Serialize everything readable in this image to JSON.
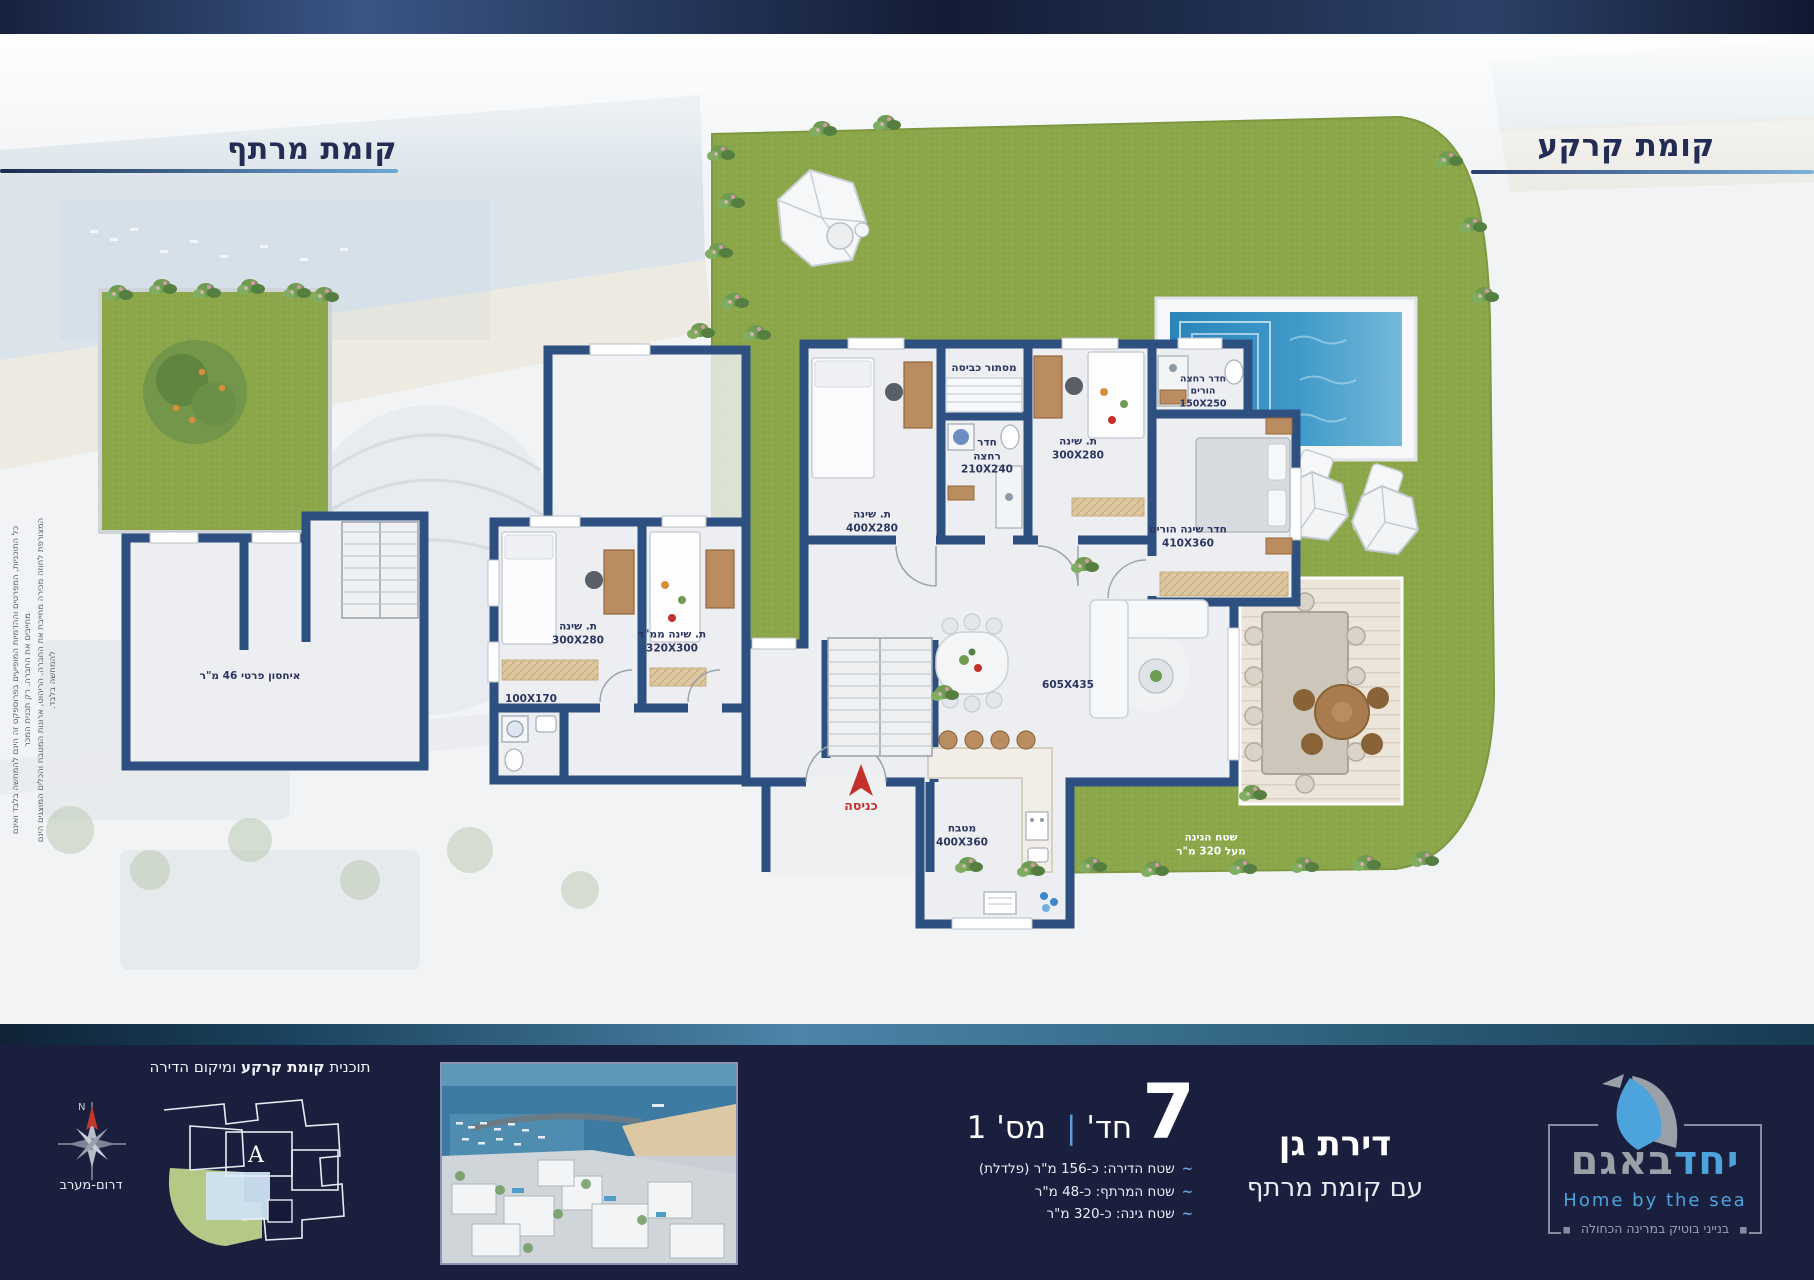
{
  "titles": {
    "ground": "קומת קרקע",
    "basement": "קומת מרתף"
  },
  "disclaimer": {
    "line1": "כל התוכניות, המפרטים וההדמיות המופיעים בפרוספקט זה הינם להמחשה בלבד ואינם מחייבים את החברה. רק תכנית המכר",
    "line2": "המצורפת לחוזה מכירה מחייבת את החברה. הריהוט, ארונות המטבח והכלים המוצגים הינם להמחשה בלבד."
  },
  "plan": {
    "ground": {
      "labels": {
        "laundry": "מסתור כביסה",
        "bath": "חדר\nרחצה\n210X240",
        "bed_top_left": "ת. שינה\n400X280",
        "bed_top_right": "ת. שינה\n300X280",
        "parents_bath": "חדר רחצה\nהורים\n150X250",
        "parents_bed": "חדר שינה הורים\n410X360",
        "bed_left": "ת. שינה\n300X280",
        "mamad": "ת. שינה ממ\"ד\n320X300",
        "small_bath": "100X170",
        "living": "605X435",
        "kitchen": "מטבח\n400X360",
        "garden": "שטח הגינה\nמעל 320 מ\"ר",
        "entrance": "כניסה"
      }
    },
    "basement": {
      "labels": {
        "storage": "איחסון פרטי 46 מ\"ר"
      }
    }
  },
  "footer": {
    "unit_type": {
      "line1": "דירת גן",
      "line2": "עם קומת מרתף"
    },
    "rooms": {
      "count": "7",
      "rooms_label": "חד'",
      "separator": "|",
      "unit_label": "מס' 1"
    },
    "areas": {
      "tilde": "~",
      "items": [
        "שטח הדירה:  כ-156 מ\"ר (פלדלת)",
        "שטח המרתף:  כ-48 מ\"ר",
        "שטח גינה:  כ-320 מ\"ר"
      ]
    },
    "diagram": {
      "title_prefix": "תוכנית ",
      "title_bold": "קומת קרקע",
      "title_suffix": " ומיקום הדירה",
      "building_letter": "A",
      "compass_n": "N",
      "compass_label": "דרום-מערב"
    },
    "logo": {
      "name_part1": "יחד",
      "name_part2": "באגם",
      "tagline_en": "Home by the sea",
      "tagline_he": "בנייני בוטיק במרינה הכחולה",
      "frame_bullet": "◼"
    }
  },
  "colors": {
    "brand_blue": "#4da3dc",
    "navy_bar": "#1a1f3e",
    "wall_blue": "#2e5080",
    "grass_green": "#8ca74a",
    "pool_blue": "#3c96c8",
    "accent_red": "#c4302b"
  }
}
